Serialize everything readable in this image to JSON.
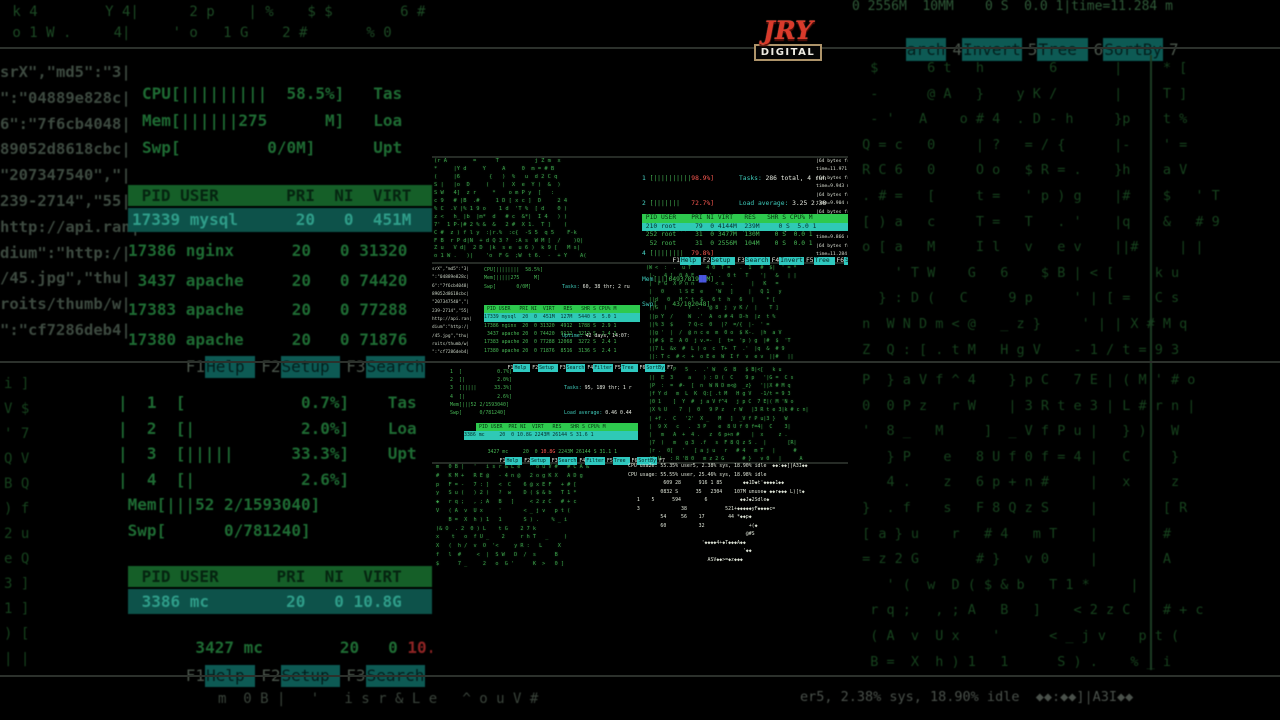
{
  "colors": {
    "terminal_green": "#46b554",
    "header_green": "#2ec94e",
    "selected_teal": "#2fc9b6",
    "fkey_teal": "#2fc9c0",
    "alert_red": "#ff5a52",
    "white_text": "#e6eae0",
    "logo_red": "#d93a2b"
  },
  "logo": {
    "title": "JRY",
    "subtitle": "DIGITAL"
  },
  "top_htop": {
    "meters": [
      {
        "n": "1 ",
        "bar": "[||||||||||",
        "val": "98.9%]"
      },
      {
        "n": "2 ",
        "bar": "[|||||||   ",
        "val": "72.7%]"
      },
      {
        "n": "3 ",
        "bar": "[||||||||| ",
        "val": "95.7%]"
      },
      {
        "n": "4 ",
        "bar": "[||||||||  ",
        "val": "79.8%]"
      }
    ],
    "mem_label": "Mem",
    "mem_a": "[|||6493/819",
    "mem_buf": "██",
    "mem_b": "M]",
    "swp_label": "Swp",
    "swp": "[    43/102048]",
    "stats": [
      {
        "label": "Tasks: ",
        "value": "286 total, 4 run"
      },
      {
        "label": "Load average: ",
        "value": "3.25 2.38"
      },
      {
        "label": "Uptime: ",
        "value": "3 days, 14:19:4"
      }
    ],
    "header": " PID USER    PRI NI VIRT   RES   SHR S CPU% M",
    "row_sel": " 210 root     79  0 4144M  239M     0 S  5.0 1",
    "rows": " 252 root     31  0 3477M  130M    0 S  0.0 1\n  52 root     31  0 2556M  104M    0 S  0.0 1",
    "fkeys": [
      {
        "n": "F1",
        "label": "Help "
      },
      {
        "n": "F2",
        "label": "Setup "
      },
      {
        "n": "F3",
        "label": "Search"
      },
      {
        "n": "F4",
        "label": "Invert"
      },
      {
        "n": "F5",
        "label": "Tree "
      },
      {
        "n": "F6",
        "label": "SortBy"
      },
      {
        "n": "F7",
        "label": ""
      }
    ]
  },
  "ping": {
    "text": "|64 bytes fro\ntime=11.971 m\n|64 bytes fro\ntime=9.943 ms\n|64 bytes fro\ntime=9.904 ms\n|64 bytes fro\ntime=11.735 m\n|64 bytes fro\ntime=9.866 ms\n|64 bytes fro\ntime=11.284 m"
  },
  "mid_htop": {
    "fragments": "srX\",\"md5\":\"3|\n\":\"04889e828c|\n6\":\"7f6cb4048|\n89052d8618cbc|\n\"207347540\",\"|\n239-2714\",\"55|\nhttp://api.ran|\ndium\":\"http:/|\n/45.jpg\",\"thu|\nroits/thumb/w|\n\":\"cf7286deb4|",
    "meters": "CPU[||||||||  58.5%]\nMem[|||||275     M]\nSwp[       0/0M]",
    "stats": [
      {
        "label": "Tasks: ",
        "value": "60, 38 thr; 2 ru"
      },
      {
        "label": "Load average: ",
        "value": "1.15 0.65"
      },
      {
        "label": "Uptime: ",
        "value": "42 days, 14:07:"
      }
    ],
    "header": " PID USER   PRI NI  VIRT   RES   SHR S CPU% M",
    "row_sel": "17339 mysql  20  0  451M  127M  5440 S  5.0 1",
    "rows": "17386 nginx  20  0 31320  4912  1788 S  2.9 1\n 3437 apache 20  0 74420  9112  3212 S  2.4 1\n17383 apache 20  0 77288 12068  3272 S  2.4 1\n17380 apache 20  0 71876  8516  3136 S  2.4 1",
    "fkeys": [
      {
        "n": "F1",
        "label": "Help "
      },
      {
        "n": "F2",
        "label": "Setup "
      },
      {
        "n": "F3",
        "label": "Search"
      },
      {
        "n": "F4",
        "label": "Filter"
      },
      {
        "n": "F5",
        "label": "Tree "
      },
      {
        "n": "F6",
        "label": "SortBy"
      },
      {
        "n": "F7",
        "label": ""
      }
    ]
  },
  "bottom_htop": {
    "meters": "1  [            0.7%]\n2  [|           2.0%]\n3  [|||||      33.3%]\n4  [|           2.6%]\nMem[|||52 2/1593040]\nSwp[      0/781240]",
    "stats": [
      {
        "label": "Tasks: ",
        "value": "95, 189 thr; 1 r"
      },
      {
        "label": "Load average: ",
        "value": "0.46 0.44"
      },
      {
        "label": "Uptime: ",
        "value": "09:52:17"
      }
    ],
    "header": " PID USER  PRI NI  VIRT   RES   SHR S CPU% M",
    "row_sel": "3386 mc     20  0 10.8G 2243M 26144 S 31.6 1",
    "row2_pre": "3427 mc     20  0 ",
    "row2_alert": "10.8G",
    "row2_post": " 2243M 26144 S 31.1 1",
    "fkeys": [
      {
        "n": "F1",
        "label": "Help "
      },
      {
        "n": "F2",
        "label": "Setup "
      },
      {
        "n": "F3",
        "label": "Search"
      },
      {
        "n": "F4",
        "label": "Filter"
      },
      {
        "n": "F5",
        "label": "Tree "
      },
      {
        "n": "F6",
        "label": "SortBy"
      },
      {
        "n": "F7",
        "label": ""
      }
    ]
  },
  "cpu_usage": {
    "text": "CPU usa2e: 55.35% user5, 2.38% sys, 18.90% idle  ◆◆:◆◆]|A3I◆◆\nCPU usage: 55.55% user, 25.46% sys, 18.98% idle\n            609 28      916 1 85       ◆◆1D◆t'◆◆◆◆1◆◆\n           0832 S      35   2304    107M unuse◆ ◆◆r◆◆◆ L)[t◆\n   1    5      594        6           ◆◆J◆2Sdle◆\n   3              38             521+◆◆◆◆◆yF◆◆◆◆c=\n           54     56    17        44 *◆◆p◆\n           60           32               +(◆\n                                        @#S\n                         '◆◆◆◆4+◆T◆◆◆A◆◆\n                                       '◆◆\n                           ASV◆◆>=◆z◆◆◆"
  },
  "matrix": {
    "top_left": "(r A        =      T           j Z m  x\n*     |Y d     Y     A     0  m = # B\n(     |6         {   )  %   u  d 2 C q\nS |   |o  D     (    |  X  e  Y )  &  )\nS W   4]  z r     *    o m P y  [   :\nc 9   # |B  .#     1 D [ x c ]  D     2 4\n% C  .V |% 1 9 o    1 d  'T %  [ d    0 )\nz <   h_ |b  |m*  d   # c  &*|  I 4   ) )\n7'  1 P-|# 2 % &  &   2 #  X 1.  T ]    (\nC #  z ) f l y  :|r.%  :c{  -S 5  q 5    F-k\nF B  r P d|N  + d Q 3 ?  :A s  W M [  /    )Q|\nZ u   V d|  2 D  |k  s e  u 6 )  k 9 [   M s|\no 1 W .   )|    'o  F G  ;W  t 6.  -  + Y    A(",
    "mid_right": "(W <  :  .  u T     4 0  T =   .  1   #  $|  ' = *\n |-   4 ]  0 A E     '  .  0 t   T    '|   &   | |\n |  F G  X P n n       < s  .      |   K   =\n |   0     l S E  e    'W   ]     |   Q 1   y\n ||d   0   H ^ t  $   6 t  h   6   |    * [\n ||G  )       r  .   @ 8  j  y K /  |    T ]\n ||p Y  /     W  .'  A  o # 4  D-h  |z  t %\n ||% 3  $     7 Q-c  0   |?  =/{  |-  ' =\n ||g '  |  /  @ n c e  m  0 o  $ K-.  |h  a V\n ||# $  E  A 0  j v.=-  [  t=  'p ) g  |#  $  'T\n ||7 L  &x  #  L ) o  c  T+  T  .'  |q  &  # 9\n ||: T c  # <  +  o E e  W  I f  v  e v  ||#   ||",
    "bot_right": "(r 2  .  P   5  .  .' W   G  B   $ B|<[   k u\n ||  E  3     a    ) : D (  C    9 p   '|G =  C s\n |P  :  =  #-  [  n  W N D m<@  _z}   '||X # M q\n |f Y d   m  L  K  Q:[ .t M   H g V   -1/t = 9 3\n |0 1    ]  Y  #  j a V f^4   j p C  7 E|( M 'N o\n |X % U    7  |  0   9 P z   r W   |3 R t e 3|k # c n|\n | +f .  C   '2'  X _   M   ]  _V f P u|3 }   W\n |  9 X   c   .  3 P    e  8 U f 0 f=4|  C    3|\n |   m   A  +  4 .   z  6 p+n #    |  x     z .\n |7  )   m   g 3  .f   s  F 8 Q z S .  |       [R|\n |r .  0[   '   [ a j u   r   # 4   m T   |      #\n |S U   : R 'B 0   m z 2 G      # }   v 0   |      A",
    "cpu_left": "m   0 B |   '   i s r & L e   ^ o u V #   # C A &\n#   K M +   R E @   - 4 n @   2 o g K X   A D g\np   F = -   7 : ]   <  C    6 @ x E F   + # [\ny   S u (   ) 2 )   ?  w    D ( $ & b   T 1 *\n◆   r q ;   , ; A   B   ]     < 2 z C   # + c\nV   ( A  v  U x     '       < _ j v   p t (\n    B =  X  h ) 1   1       S ) .    % _ i\n)& O  . 2  0 ) L    t G    2 7 k\nx    t   o  f U _    2     r h T   _     )\nX   (  h /  v  O  '<     y R :   L     X\nf   l  #     <  |  S W   D  /  s      B\n$      7 _     2   o  G '      K  >   0 ]"
  },
  "bg": {
    "top_matrix": " k 4        Y 4|      2 p    | %    $ $        6 # ]\n o 1 W .     4|     ' o   1 G    2 #       % 0",
    "fragments": "srX\",\"md5\":\"3|\n\":\"04889e828c|\n6\":\"7f6cb4048|\n89052d8618cbc|\n\"207347540\",\"|\n239-2714\",\"55|\nhttp://api.ran|\ndium\":\"http:/|\n/45.jpg\",\"thu|\nroits/thumb/w|\n\":\"cf7286deb4|",
    "meters": "CPU[|||||||||  58.5%]   Tas\nMem[||||||275      M]   Loa\nSwp[         0/0M]      Upt",
    "header": " PID USER       PRI  NI  VIRT",
    "row_sel": "17339 mysql      20   0  451M",
    "rows": "17386 nginx      20   0 31320\n 3437 apache     20   0 74420\n17383 apache     20   0 77288\n17380 apache     20   0 71876",
    "fkeys": [
      {
        "n": "F1",
        "label": "Help "
      },
      {
        "n": "F2",
        "label": "Setup "
      },
      {
        "n": "F3",
        "label": "Search"
      },
      {
        "n": "F4",
        "label": "Filt"
      }
    ],
    "side_col": "i ]\nV $\n' 7\nQ V\nB Q\n) f\n2 u\ne Q\n3 ]\n1 ]\n) [\n| |",
    "meters2": "|  1  [            0.7%]    Tas\n|  2  [|           2.0%]    Loa\n|  3  [|||||      33.3%]    Upt\n|  4  [|           2.6%]\n Mem[|||52 2/1593040]\n Swp[      0/781240]",
    "header2": " PID USER      PRI  NI  VIRT",
    "row2_sel": " 3386 mc        20   0 10.8G",
    "row2_pre": " 3427 mc        20   0 ",
    "row2_alert": "10.8G",
    "fkeys2": [
      {
        "n": "F1",
        "label": "Help "
      },
      {
        "n": "F2",
        "label": "Setup "
      },
      {
        "n": "F3",
        "label": "Search"
      },
      {
        "n": "F4",
        "label": "Filt"
      }
    ],
    "right_row": "0 2556M  10MM    0 S  0.0 1|time=11.284 m",
    "fkeys_top": [
      {
        "n": "",
        "label": "arch"
      },
      {
        "n": "4",
        "label": "Invert"
      },
      {
        "n": "5",
        "label": "Tree "
      },
      {
        "n": "6",
        "label": "SortBy"
      },
      {
        "n": "7",
        "label": ""
      }
    ],
    "right_matrix1": "  $      6 t   h        6       |     * [\n  -      @ A   }    y K /       |     T ]\n  - '   A    o # 4  . D - h     }p    t %\n Q = c   0     | ?   = / {      |-    ' =\n R C 6   0     O o   $ R = .    }h    a V\n . # =   [     t =   ' p ) g    |#    $   ' T\n [ ) a   c     T =   T   . '    |q    &   # 9\n o [ a   M     I l   v   e v    ||#     | |\n     ' T W    G   6    $ B | < [     k u\n   } : D (   C     9 p     ' | [ =   C s\n n  W N D m < @   _ z }     ' | | X # M q\n Z  Q : [ . t M   H g V    - 1 / t = 9 3",
    "right_matrix2": " P  } a V f ^ 4    } p C   7 E | ( M ' # o\n 0  0 P z   r W    | 3 R t e 3 | L # r n |\n '  8 _   M     ]  _ V f P u |   } )   W\n    } P    e   8 U f 0 f = 4 |   C     }\n    4 .    z   6 p + n #     |   x     z\n }  . f    s   F 8 Q z S     |        [ R\n [ a } u    r   # 4   m T    |        #\n = z 2 G       # }   v 0     |        A\n    ' (  w  D ( $ & b   T 1 *     |\n  r q ;   , ; A   B   ]    < 2 z C    # + c\n  ( A  v  U x    '      < _ j v    p t (\n  B =  X  h ) 1   1      S ) .    % _ i",
    "bottom_left": "m  0 B |   '   i s r & L e   ^ o u V #",
    "bottom_right": "er5, 2.38% sys, 18.90% idle  ◆◆:◆◆]|A3I◆◆"
  }
}
